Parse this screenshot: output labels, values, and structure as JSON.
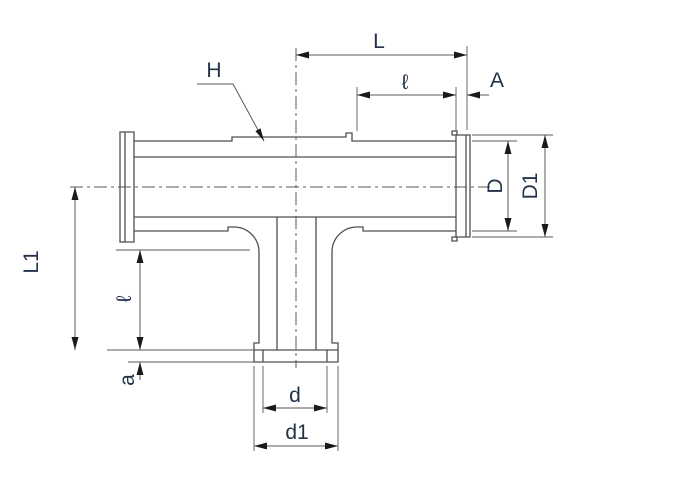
{
  "drawing": {
    "type": "technical-dimension-drawing",
    "subject": "tee-fitting-side-view",
    "labels": {
      "L": "L",
      "ell_top": "ℓ",
      "A": "A",
      "H": "H",
      "D": "D",
      "D1": "D1",
      "L1": "L1",
      "ell_branch": "ℓ",
      "a": "a",
      "d": "d",
      "d1": "d1"
    },
    "colors": {
      "background": "#ffffff",
      "outline": "#4f4f4f",
      "dimension_lines": "#5a5a5a",
      "arrowheads": "#1a1a1a",
      "label_text": "#223349"
    }
  }
}
